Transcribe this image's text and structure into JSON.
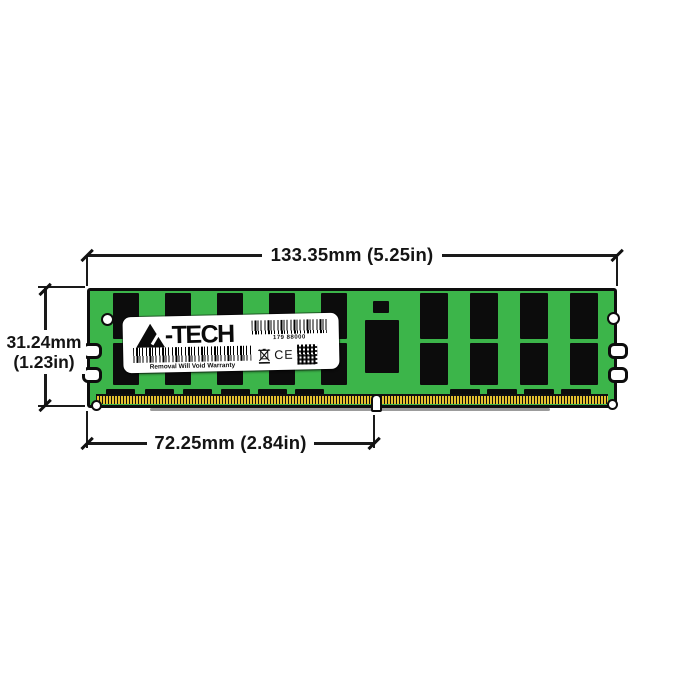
{
  "diagram": {
    "top_dimension": "133.35mm (5.25in)",
    "side_dimension_mm": "31.24mm",
    "side_dimension_in": "(1.23in)",
    "notch_dimension": "72.25mm (2.84in)"
  },
  "module": {
    "pcb_color": "#3CB54A",
    "chip_color": "#0C0C0C",
    "pin_color": "#E6C22F",
    "label": {
      "brand": "A-TECH",
      "brand_text": "-TECH",
      "serial": "179 88000",
      "warning": "Removal Will Void Warranty",
      "ce_mark": "CE"
    },
    "icons": {
      "logo": "a-tech-triangle-logo-icon",
      "barcodes": "barcode-icon",
      "weee": "weee-crossed-bin-icon",
      "qr": "qr-code-icon"
    }
  }
}
